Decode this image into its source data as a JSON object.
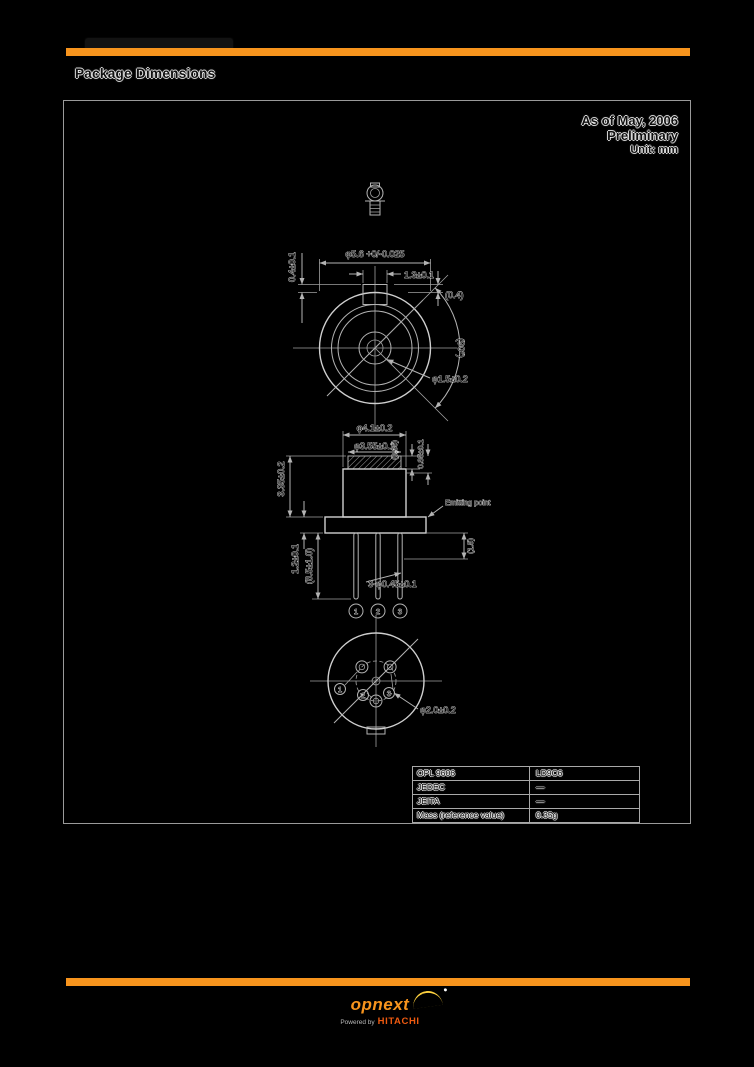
{
  "header": {
    "title": "Package Dimensions"
  },
  "meta": {
    "as_of": "As of May, 2006",
    "status": "Preliminary",
    "unit": "Unit: mm"
  },
  "drawing": {
    "dims": {
      "cap_od": "φ5.6 +0/-0.025",
      "tab_width": "1.3±0.1",
      "tab_thickness": "(0.4)",
      "tab_height": "0.4±0.1",
      "view_angle": "(90°)",
      "aperture": "φ1.5±0.2",
      "cap_dia": "φ4.1±0.2",
      "window_dia": "φ3.55±0.1",
      "window_recess": "(0.35)",
      "window_offset": "0.85±0.1",
      "cap_height": "3.35±0.2",
      "flange_thickness": "1.2±0.1",
      "lead_length": "(8.5±1.0)",
      "lead_dia": "3-φ0.45±0.1",
      "emitting_point": "Emitting point",
      "lead_standoff": "(1.5)",
      "pcd": "φ2.0±0.2"
    },
    "pins": [
      "1",
      "2",
      "3"
    ]
  },
  "table": {
    "rows": [
      [
        "OPL 9606",
        "LD9C6"
      ],
      [
        "JEDEC",
        "—"
      ],
      [
        "JEITA",
        "—"
      ],
      [
        "Mass (reference value)",
        "0.35g"
      ]
    ]
  },
  "footer": {
    "brand": "opnext",
    "powered_by": "Powered by",
    "maker": "HITACHI"
  },
  "colors": {
    "accent_orange": "#F7941D"
  }
}
